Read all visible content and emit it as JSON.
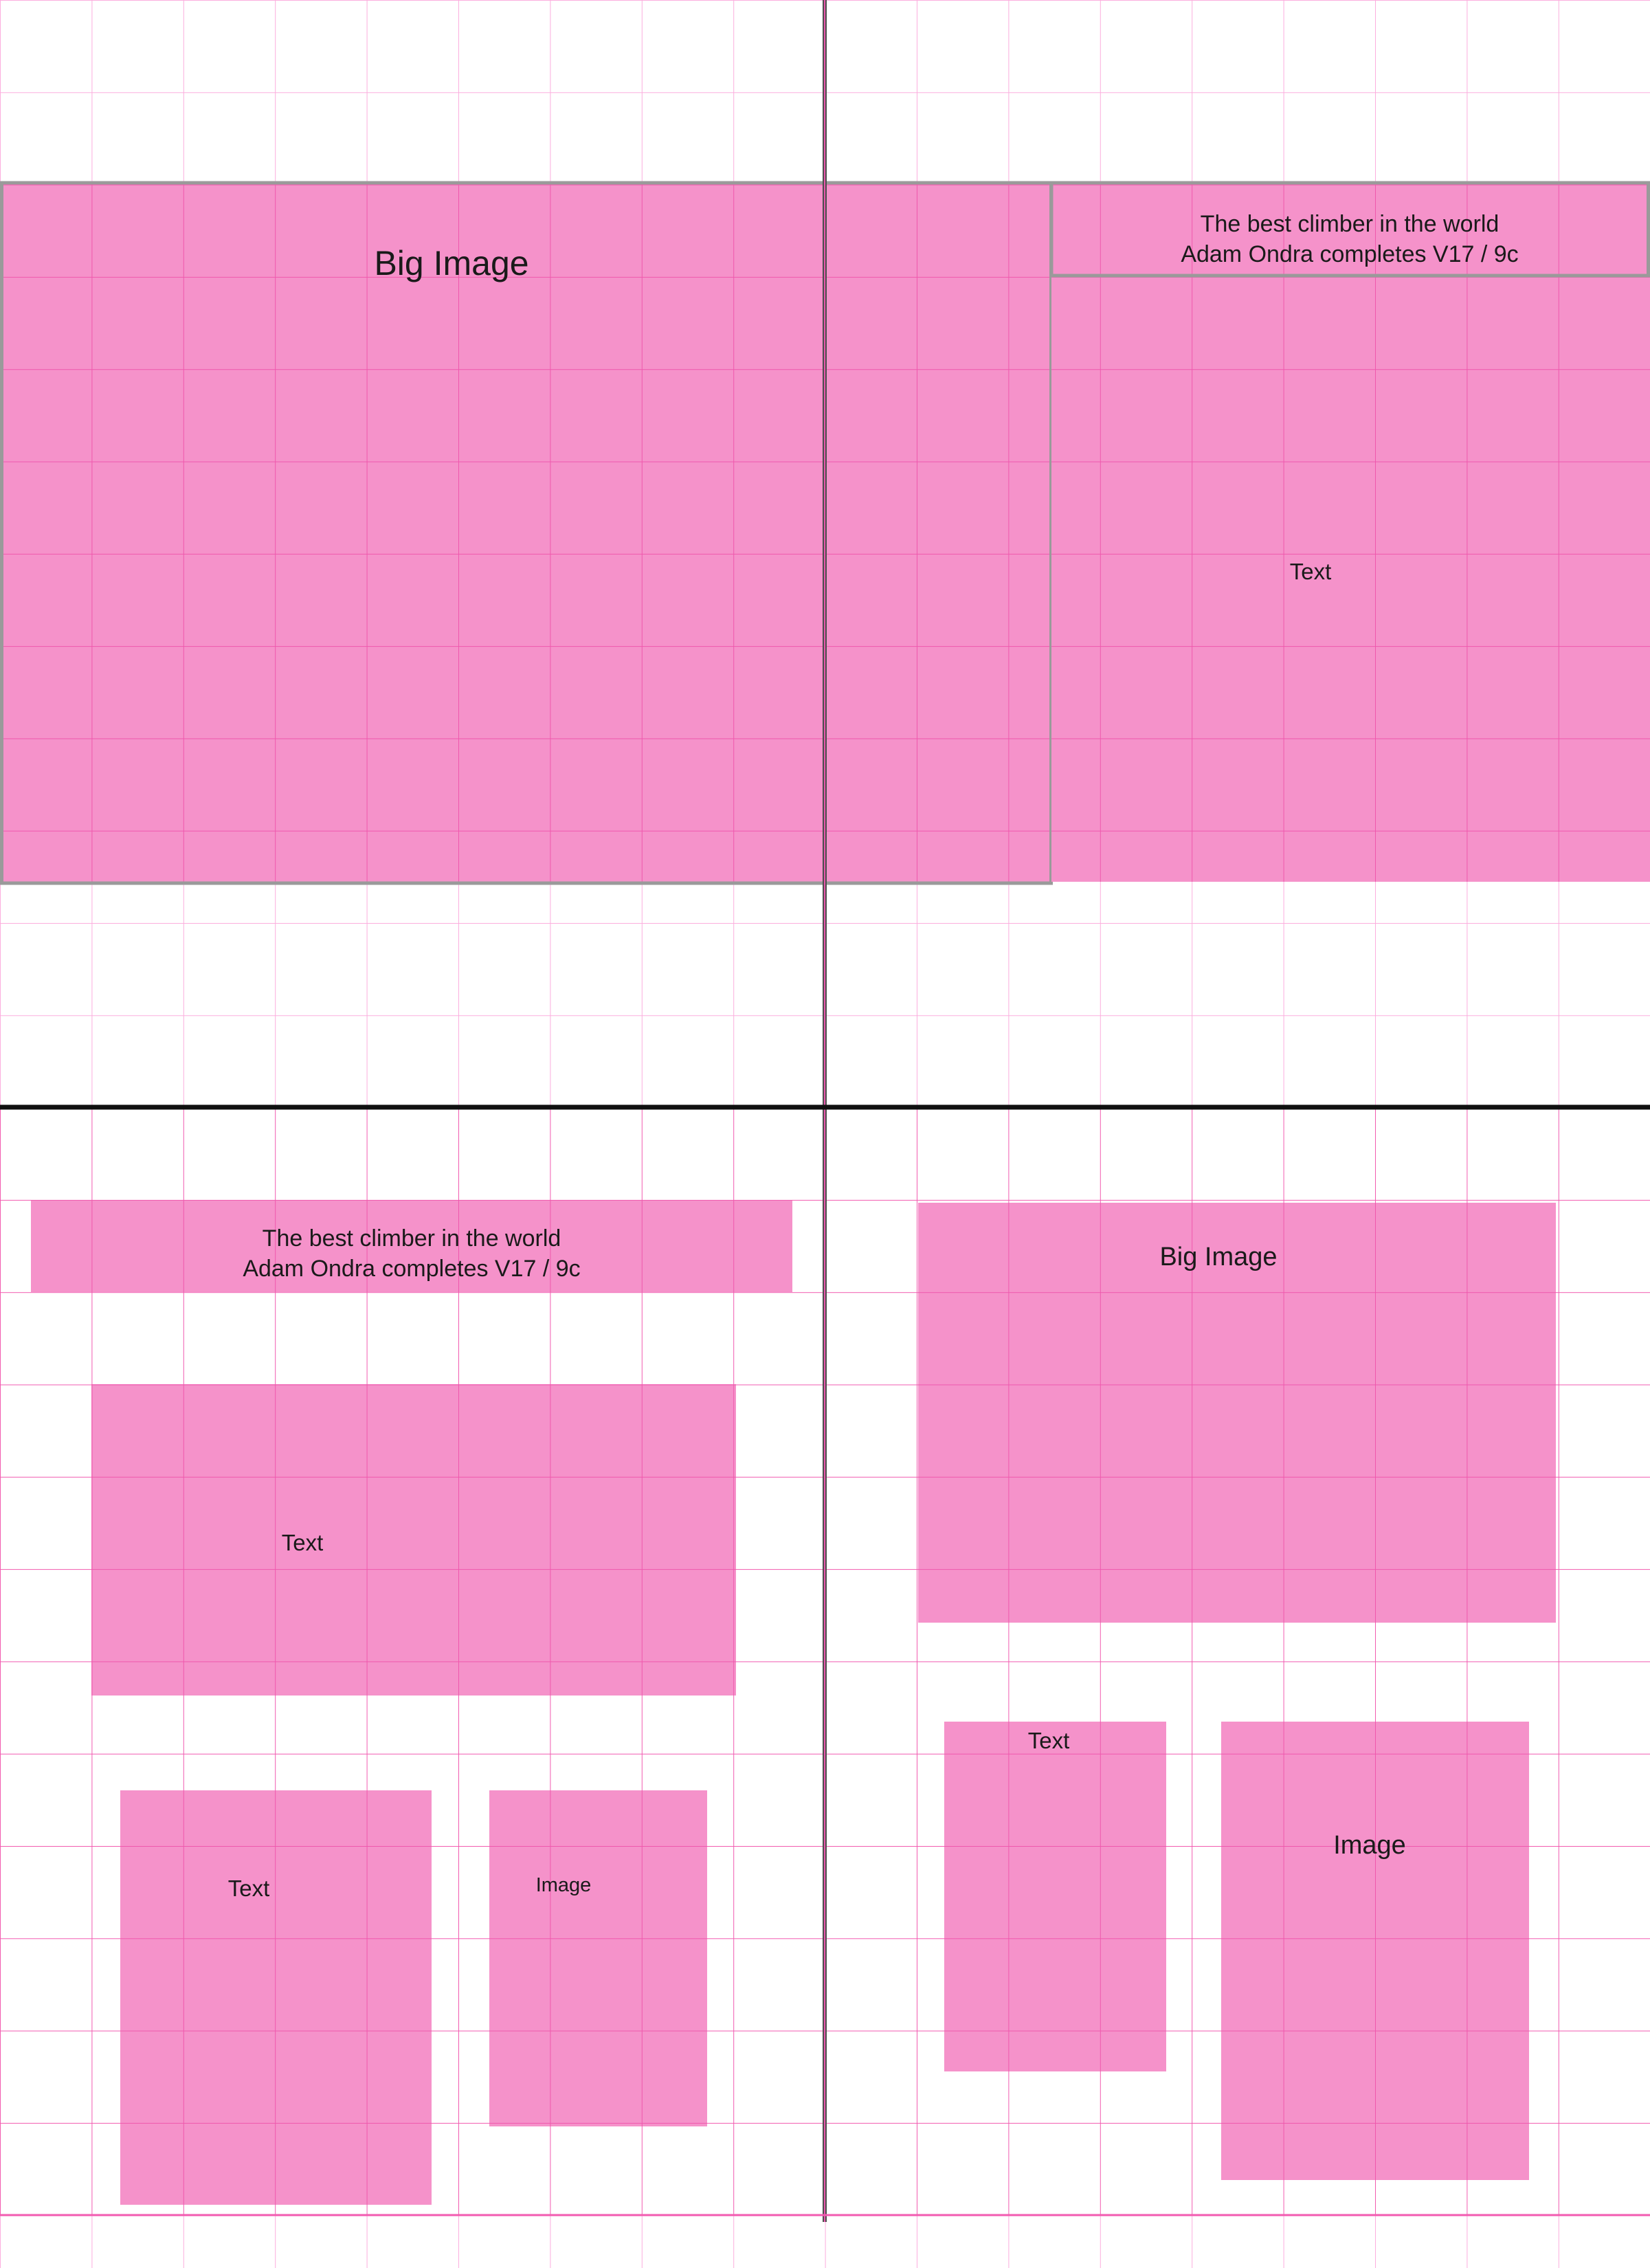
{
  "document": {
    "description": "Newspaper spread layout wireframe on pink layout grid",
    "colors": {
      "block_pink": "#f592ca",
      "grid_light": "#fcaede",
      "grid_strong": "#f25bb0",
      "in_block_grid": "#ef58ad",
      "fold_line_black": "#101010",
      "guide_dark_gray": "#4d4d4d",
      "frame_border_gray": "#9a9a9a"
    }
  },
  "top_left": {
    "big_image_label": "Big Image"
  },
  "top_right": {
    "headline_line1": "The best climber in the world",
    "headline_line2": "Adam Ondra completes V17 / 9c",
    "text_label": "Text"
  },
  "bottom_left": {
    "headline_line1": "The best climber in the world",
    "headline_line2": "Adam Ondra completes V17 / 9c",
    "text_block_label": "Text",
    "text_column_label": "Text",
    "image_label": "Image"
  },
  "bottom_right": {
    "big_image_label": "Big Image",
    "text_label": "Text",
    "image_label": "Image"
  }
}
